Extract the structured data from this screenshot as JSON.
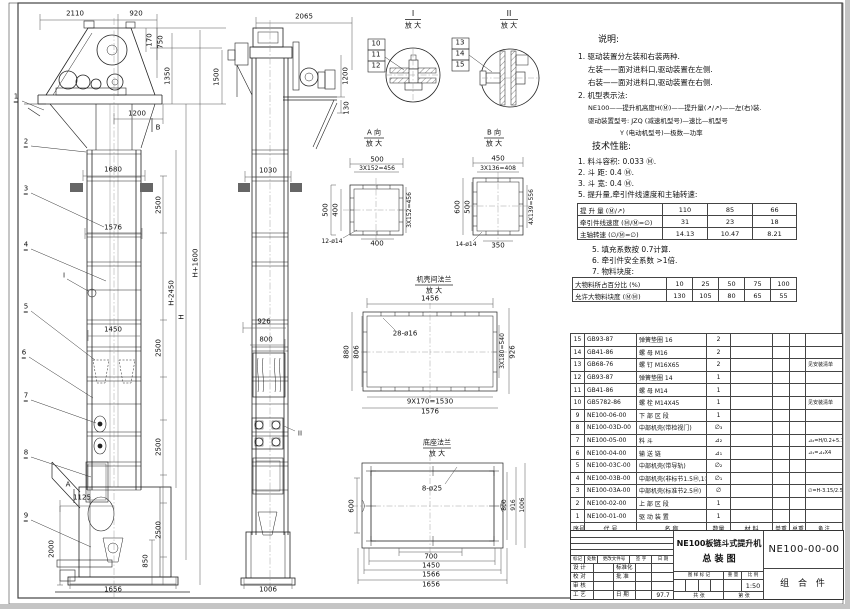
{
  "front": {
    "dims": {
      "w2110": "2110",
      "w920": "920",
      "h170": "170",
      "h750": "750",
      "h1350": "1350",
      "h1500": "1500",
      "w1200": "1200",
      "w1680": "1680",
      "w1576": "1576",
      "w1450": "1450",
      "s2500a": "2500",
      "s2500b": "2500",
      "s2500c": "2500",
      "s2500d": "2500",
      "hm": "H-2450",
      "h": "H",
      "hp": "H+1600",
      "w1125": "1125",
      "h2000": "2000",
      "h850": "850",
      "w1656": "1656"
    },
    "balloons": [
      "1",
      "2",
      "3",
      "4",
      "5",
      "6",
      "7",
      "8",
      "9"
    ],
    "markers": {
      "a": "A",
      "b": "B",
      "i": "I"
    }
  },
  "side": {
    "dims": {
      "w2065": "2065",
      "h1200": "1200",
      "h130": "130",
      "w1030": "1030",
      "w926": "926",
      "w800": "800",
      "w1006": "1006"
    },
    "marker": "II"
  },
  "det": {
    "i": {
      "t": "I",
      "s": "放 大",
      "b": [
        "10",
        "11",
        "12"
      ]
    },
    "ii": {
      "t": "II",
      "s": "放 大",
      "b": [
        "13",
        "14",
        "15"
      ]
    },
    "a": {
      "t": "A 向",
      "s": "放 大",
      "d": [
        "500",
        "3X152=456",
        "500",
        "400",
        "3X152=456",
        "400",
        "12-ø14"
      ]
    },
    "b": {
      "t": "B 向",
      "s": "放 大",
      "d": [
        "450",
        "3X136=408",
        "600",
        "500",
        "4X139=556",
        "350",
        "14-ø14"
      ]
    },
    "c": {
      "t": "机壳间法兰",
      "s": "放 大",
      "d": [
        "1456",
        "28-ø16",
        "880",
        "806",
        "3X180=540",
        "926",
        "9X170=1530",
        "1576"
      ]
    },
    "f": {
      "t": "底座法兰",
      "s": "放 大",
      "d": [
        "8-ø25",
        "600",
        "800",
        "916",
        "1006",
        "700",
        "1450",
        "1566",
        "1656"
      ]
    }
  },
  "notes": {
    "h": "说明:",
    "l1": "1. 驱动装置分左装和右装两种.",
    "l2": "左装——面对进料口,驱动装置在左侧.",
    "l3": "右装——面对进料口,驱动装置在右侧.",
    "l4": "2. 机型表示法:",
    "f1": "NE100——提升机高度H(Ⓜ)——提升量(↗/↗)——左(右)装.",
    "f2": "驱动装置型号: JZQ (减速机型号)—速比—机型号",
    "f3": "Y (电动机型号)—极数—功率"
  },
  "tech": {
    "h": "技术性能:",
    "i1": "1. 料斗容积: 0.033 Ⓜ.",
    "i2": "2. 斗  距: 0.4 Ⓜ.",
    "i3": "3. 斗  宽: 0.4 Ⓜ.",
    "i4": "5. 提升量,牵引件线速度和主轴转速:",
    "t1": {
      "r1": {
        "l": "提 升 量 (Ⓜ/↗)",
        "v1": "110",
        "v2": "85",
        "v3": "66"
      },
      "r2": {
        "l": "牵引件线速度 (Ⓜ/Ⓜ=∅)",
        "v1": "31",
        "v2": "23",
        "v3": "18"
      },
      "r3": {
        "l": "主轴转速 (∅/Ⓜ=∅)",
        "v1": "14.13",
        "v2": "10.47",
        "v3": "8.21"
      }
    },
    "n5": "5. 填充系数按 0.7计算.",
    "n6": "6. 牵引件安全系数 >1倍.",
    "n7": "7. 物料块度:",
    "t2": {
      "r1": {
        "l": "大物料所占百分比 (%)",
        "v1": "10",
        "v2": "25",
        "v3": "50",
        "v4": "75",
        "v5": "100"
      },
      "r2": {
        "l": "允许大物料块度 (ⓂⓂ)",
        "v1": "130",
        "v2": "105",
        "v3": "80",
        "v4": "65",
        "v5": "55"
      }
    }
  },
  "bom": {
    "header": [
      "序号",
      "代  号",
      "名  称",
      "数量",
      "材  料",
      "单重",
      "总重",
      "备  注"
    ],
    "rows": [
      {
        "no": "15",
        "code": "GB93-87",
        "name": "弹簧垫圈  16",
        "qty": "2",
        "mat": "",
        "w1": "",
        "w2": "",
        "remark": ""
      },
      {
        "no": "14",
        "code": "GB41-86",
        "name": "螺  母  M16",
        "qty": "2",
        "mat": "",
        "w1": "",
        "w2": "",
        "remark": ""
      },
      {
        "no": "13",
        "code": "GB68-76",
        "name": "螺  钉  M16X65",
        "qty": "2",
        "mat": "",
        "w1": "",
        "w2": "",
        "remark": "见安装清单"
      },
      {
        "no": "12",
        "code": "GB93-87",
        "name": "弹簧垫圈  14",
        "qty": "1",
        "mat": "",
        "w1": "",
        "w2": "",
        "remark": ""
      },
      {
        "no": "11",
        "code": "GB41-86",
        "name": "螺  母  M14",
        "qty": "1",
        "mat": "",
        "w1": "",
        "w2": "",
        "remark": ""
      },
      {
        "no": "10",
        "code": "GB5782-86",
        "name": "螺  栓  M14X45",
        "qty": "1",
        "mat": "",
        "w1": "",
        "w2": "",
        "remark": "见安装清单"
      },
      {
        "no": "9",
        "code": "NE100-06-00",
        "name": "下 部 区 段",
        "qty": "1",
        "mat": "",
        "w1": "",
        "w2": "",
        "remark": ""
      },
      {
        "no": "8",
        "code": "NE100-03D-00",
        "name": "中部机壳(带检视门)",
        "qty": "∅₃",
        "mat": "",
        "w1": "",
        "w2": "",
        "remark": ""
      },
      {
        "no": "7",
        "code": "NE100-05-00",
        "name": "料  斗",
        "qty": "⊿₂",
        "mat": "",
        "w1": "",
        "w2": "",
        "remark": "⊿₂=H/0.2+5.75"
      },
      {
        "no": "6",
        "code": "NE100-04-00",
        "name": "输 送 链",
        "qty": "⊿₁",
        "mat": "",
        "w1": "",
        "w2": "",
        "remark": "⊿₁=⊿₂X4"
      },
      {
        "no": "5",
        "code": "NE100-03C-00",
        "name": "中部机壳(带导轨)",
        "qty": "∅₂",
        "mat": "",
        "w1": "",
        "w2": "",
        "remark": ""
      },
      {
        "no": "4",
        "code": "NE100-03B-00",
        "name": "中部机壳(非标节1.5Ⓜ,1Ⓜ)",
        "qty": "∅₁",
        "mat": "",
        "w1": "",
        "w2": "",
        "remark": ""
      },
      {
        "no": "3",
        "code": "NE100-03A-00",
        "name": "中部机壳(标准节2.5Ⓜ)",
        "qty": "∅",
        "mat": "",
        "w1": "",
        "w2": "",
        "remark": "∅=H-3.15/2.5"
      },
      {
        "no": "2",
        "code": "NE100-02-00",
        "name": "上 部 区 段",
        "qty": "1",
        "mat": "",
        "w1": "",
        "w2": "",
        "remark": ""
      },
      {
        "no": "1",
        "code": "NE100-01-00",
        "name": "驱 动 装 置",
        "qty": "1",
        "mat": "",
        "w1": "",
        "w2": "",
        "remark": ""
      }
    ]
  },
  "tb": {
    "rev1": "标记",
    "rev2": "处数",
    "rev3": "更改文件号",
    "rev4": "签 字",
    "rev5": "日 期",
    "r1a": "设 计",
    "r1b": "标准化",
    "r2a": "校 对",
    "r2b": "批 准",
    "r3a": "审 核",
    "r4a": "工 艺",
    "r4b": "日 期",
    "r4c": "97.7",
    "title1": "NE100板链斗式提升机",
    "title2": "总  装  图",
    "g1": "图 样 标 记",
    "g2": "重 量",
    "g3": "比 例",
    "scale": "1:50",
    "b1": "共  张",
    "b2": "第  张",
    "code": "NE100-00-00",
    "part": "组 合 件"
  }
}
